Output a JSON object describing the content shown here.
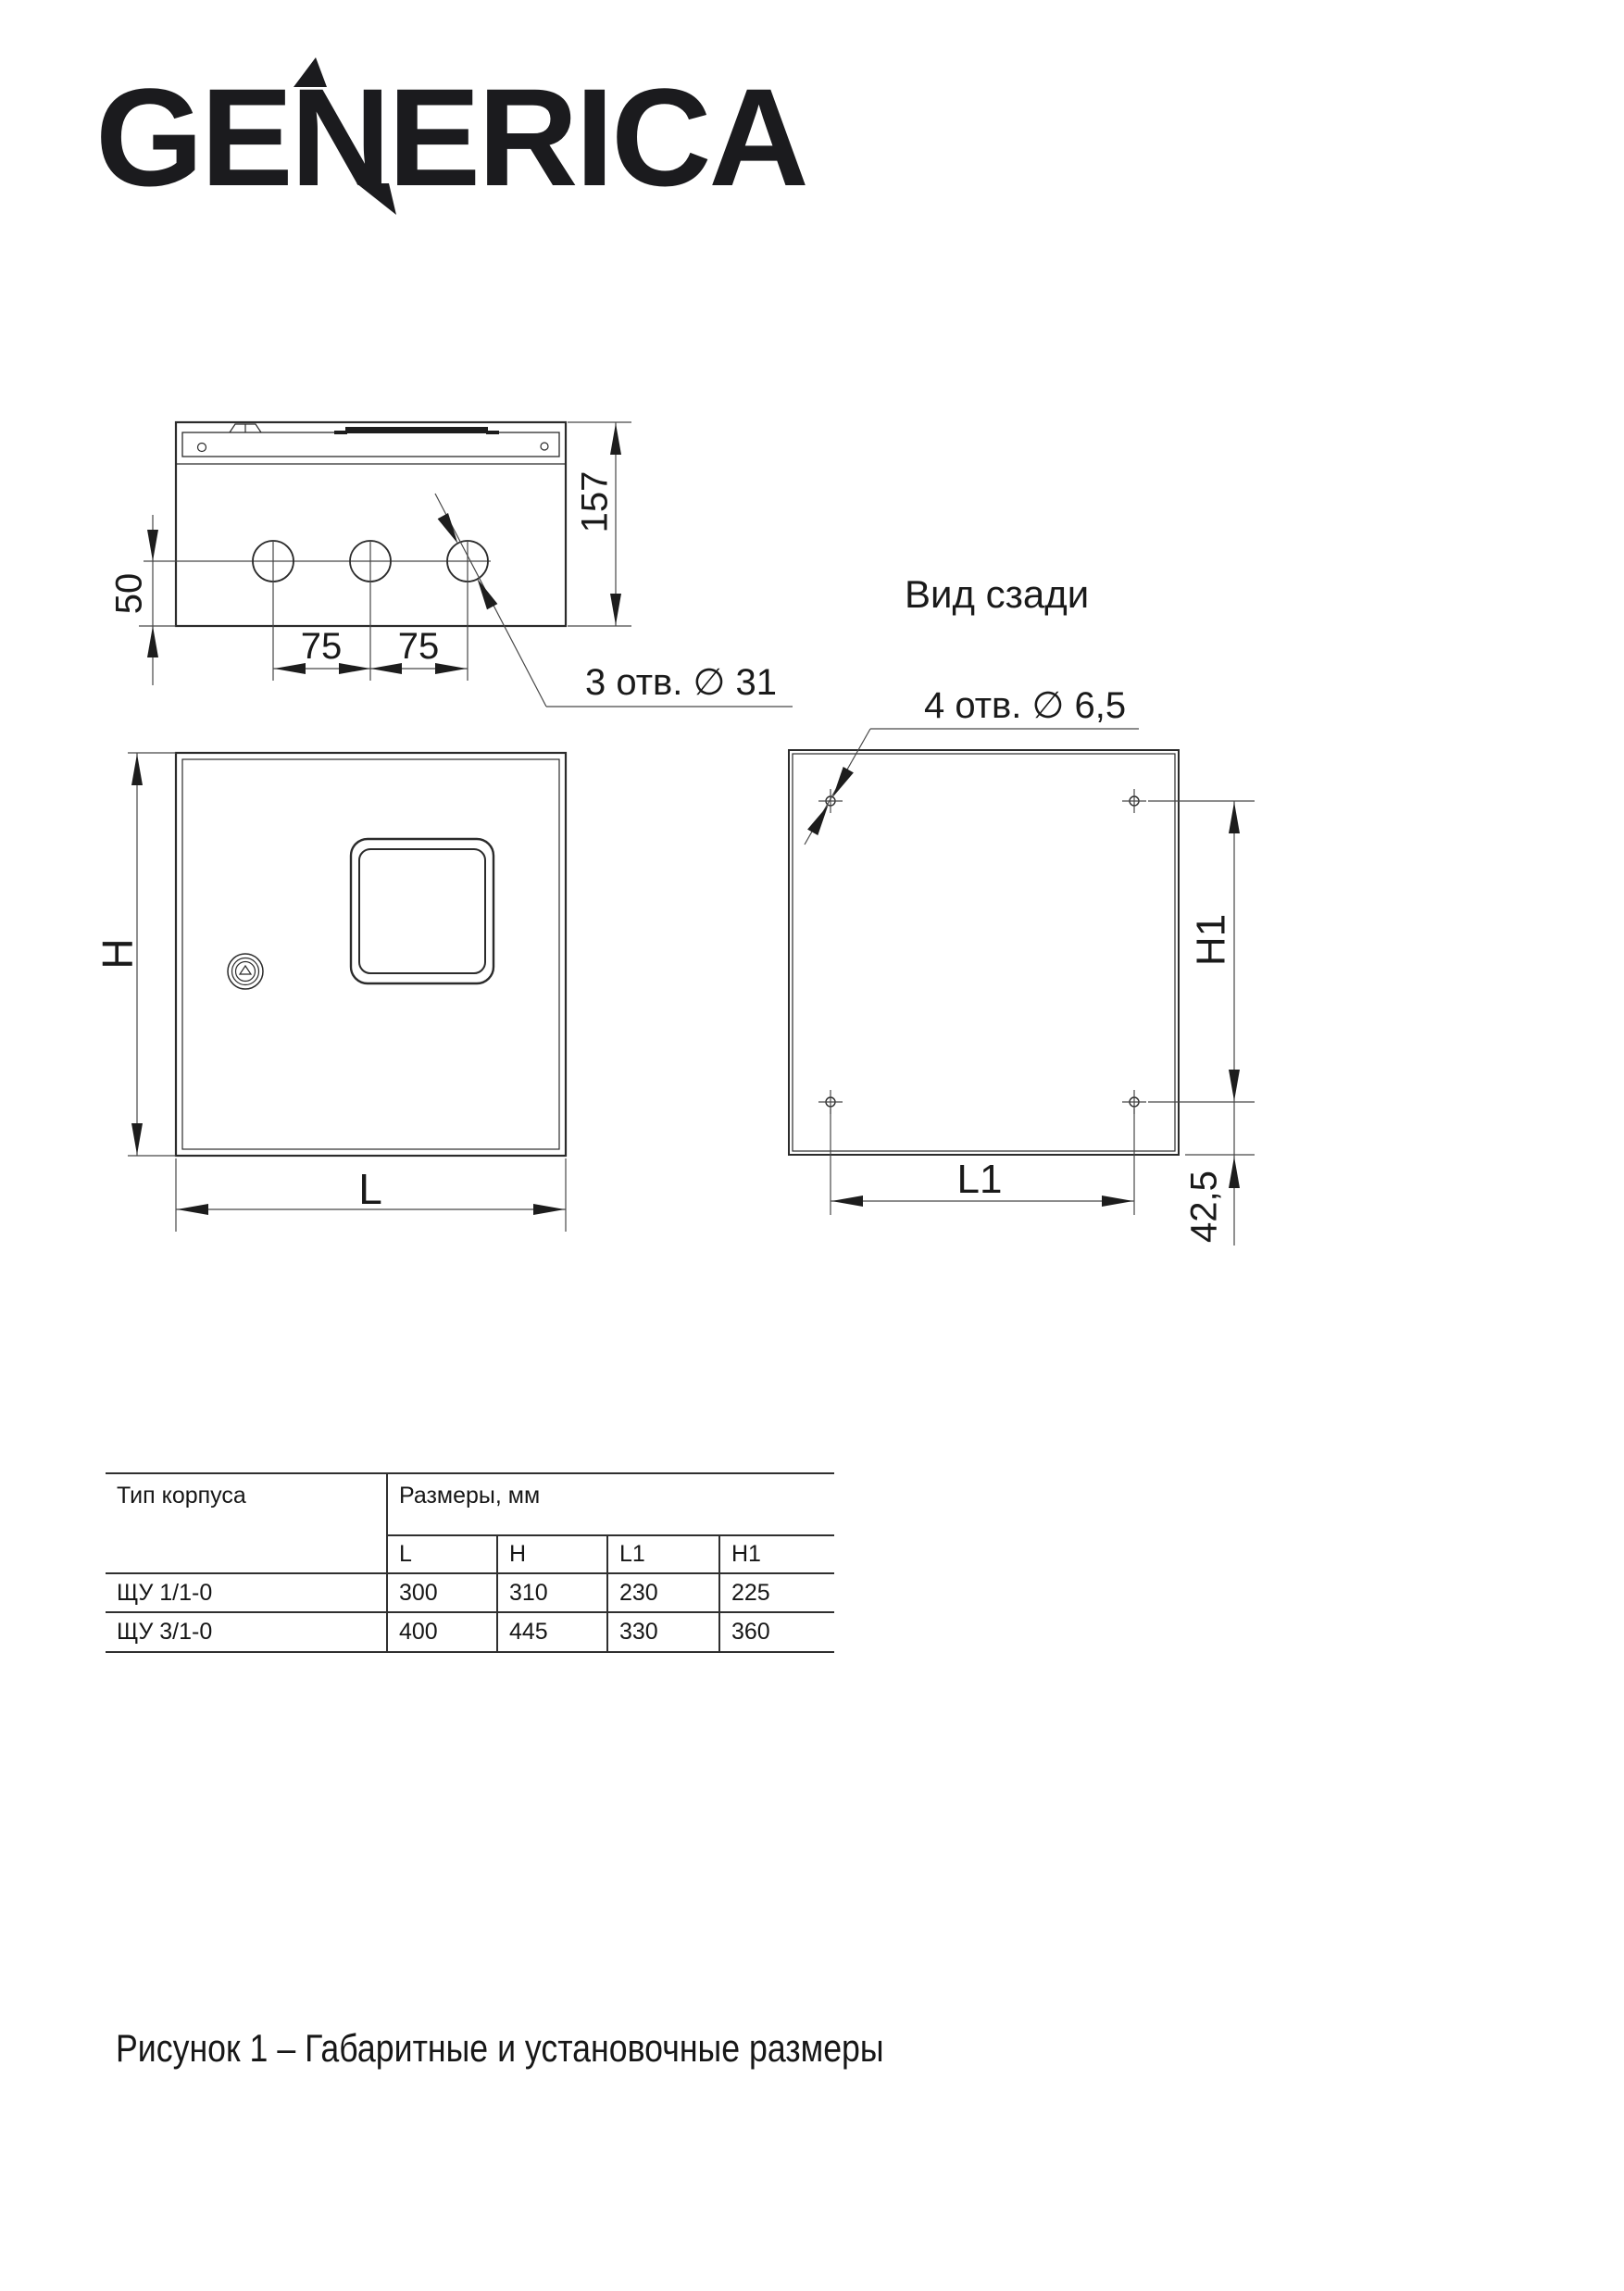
{
  "logo": {
    "part1": "GE",
    "part2": "N",
    "part3": "ERICA"
  },
  "top_view": {
    "hole_offset": "50",
    "spacing_left": "75",
    "spacing_right": "75",
    "depth": "157",
    "holes_label": "3 отв. ∅ 31"
  },
  "front_view": {
    "height_label": "H",
    "width_label": "L"
  },
  "rear_view": {
    "title": "Вид сзади",
    "holes_label": "4 отв. ∅ 6,5",
    "height_label": "H1",
    "width_label": "L1",
    "bottom_offset": "42,5"
  },
  "table": {
    "col_type": "Тип корпуса",
    "col_dims": "Размеры, мм",
    "sub_cols": [
      "L",
      "H",
      "L1",
      "H1"
    ],
    "rows": [
      {
        "type": "ЩУ 1/1-0",
        "values": [
          "300",
          "310",
          "230",
          "225"
        ]
      },
      {
        "type": "ЩУ 3/1-0",
        "values": [
          "400",
          "445",
          "330",
          "360"
        ]
      }
    ]
  },
  "caption": "Рисунок 1 – Габаритные и установочные размеры"
}
